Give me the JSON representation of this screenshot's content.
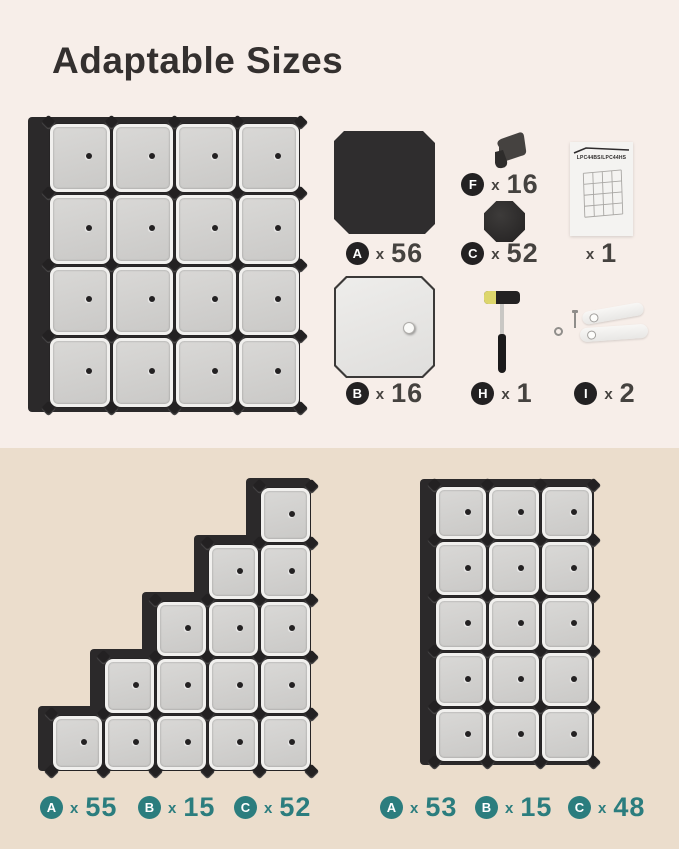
{
  "title": "Adaptable Sizes",
  "times": "x",
  "colors": {
    "accent_teal": "#2b7d7e",
    "background_top": "#f7eee9",
    "background_bottom": "#ebddcc",
    "frame_black": "#2b292a",
    "door_gray": "#d2d1cf"
  },
  "parts": {
    "a": {
      "badge": "A",
      "qty": "56"
    },
    "b": {
      "badge": "B",
      "qty": "16"
    },
    "c": {
      "badge": "C",
      "qty": "52"
    },
    "f": {
      "badge": "F",
      "qty": "16"
    },
    "h": {
      "badge": "H",
      "qty": "1"
    },
    "i": {
      "badge": "I",
      "qty": "2"
    },
    "manual": {
      "label": "LPC44BS/LPC44HS",
      "qty": "1"
    }
  },
  "units": {
    "main": {
      "cols": 4,
      "rows": 4
    },
    "staircase": {
      "column_heights": [
        1,
        2,
        3,
        4,
        5
      ]
    },
    "tower": {
      "cols": 3,
      "rows": 5
    }
  },
  "configurations": {
    "staircase": {
      "counts": [
        {
          "badge": "A",
          "qty": "55"
        },
        {
          "badge": "B",
          "qty": "15"
        },
        {
          "badge": "C",
          "qty": "52"
        }
      ]
    },
    "tower": {
      "counts": [
        {
          "badge": "A",
          "qty": "53"
        },
        {
          "badge": "B",
          "qty": "15"
        },
        {
          "badge": "C",
          "qty": "48"
        }
      ]
    }
  }
}
